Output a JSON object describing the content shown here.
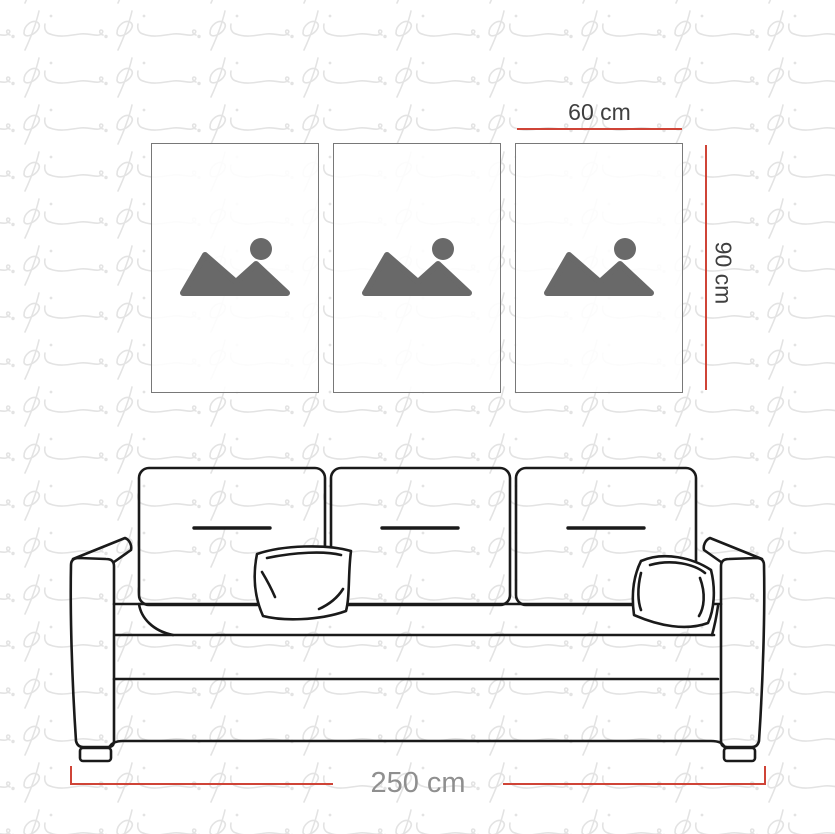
{
  "watermark": {
    "text": "pi",
    "style": "tiled script brand logo"
  },
  "colors": {
    "watermark": "#e3e3e3",
    "dimension_line": "#cf4437",
    "dimension_text": "#3f3f3f",
    "sofa_width_text": "#8f8f8f",
    "sofa_outline": "#1a1a1a",
    "panel_border": "#787878",
    "placeholder_icon": "#696969",
    "panel_fill": "rgba(255,255,255,0.88)"
  },
  "panels": {
    "count": 3,
    "icon": "image-placeholder-mountains",
    "width_label": "60 cm",
    "height_label": "90 cm"
  },
  "sofa": {
    "width_label": "250 cm",
    "description": "three-seat sofa line drawing with two throw pillows",
    "back_cushions": 3,
    "throw_pillows": 2
  }
}
